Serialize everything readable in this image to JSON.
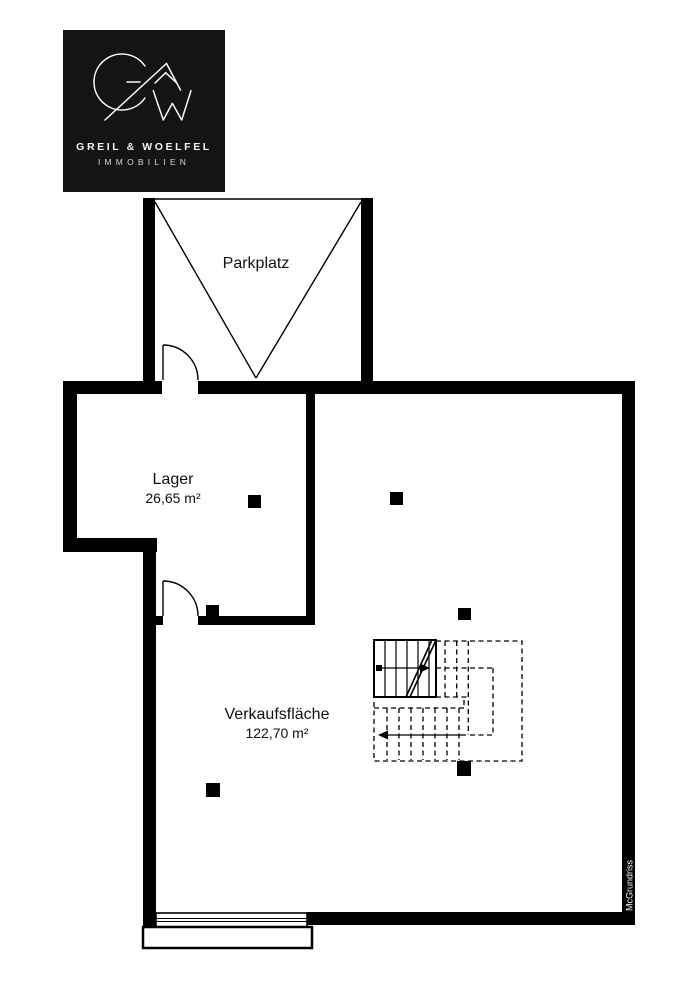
{
  "logo": {
    "company": "GREIL & WOELFEL",
    "subtitle": "IMMOBILIEN"
  },
  "rooms": {
    "parkplatz": {
      "name": "Parkplatz"
    },
    "lager": {
      "name": "Lager",
      "area": "26,65 m²"
    },
    "verkaufsflaeche": {
      "name": "Verkaufsfläche",
      "area": "122,70 m²"
    }
  },
  "watermark": "McGrundriss",
  "colors": {
    "wall": "#000000",
    "background": "#ffffff",
    "logo_background": "#141414",
    "logo_foreground": "#f5f5f5"
  }
}
